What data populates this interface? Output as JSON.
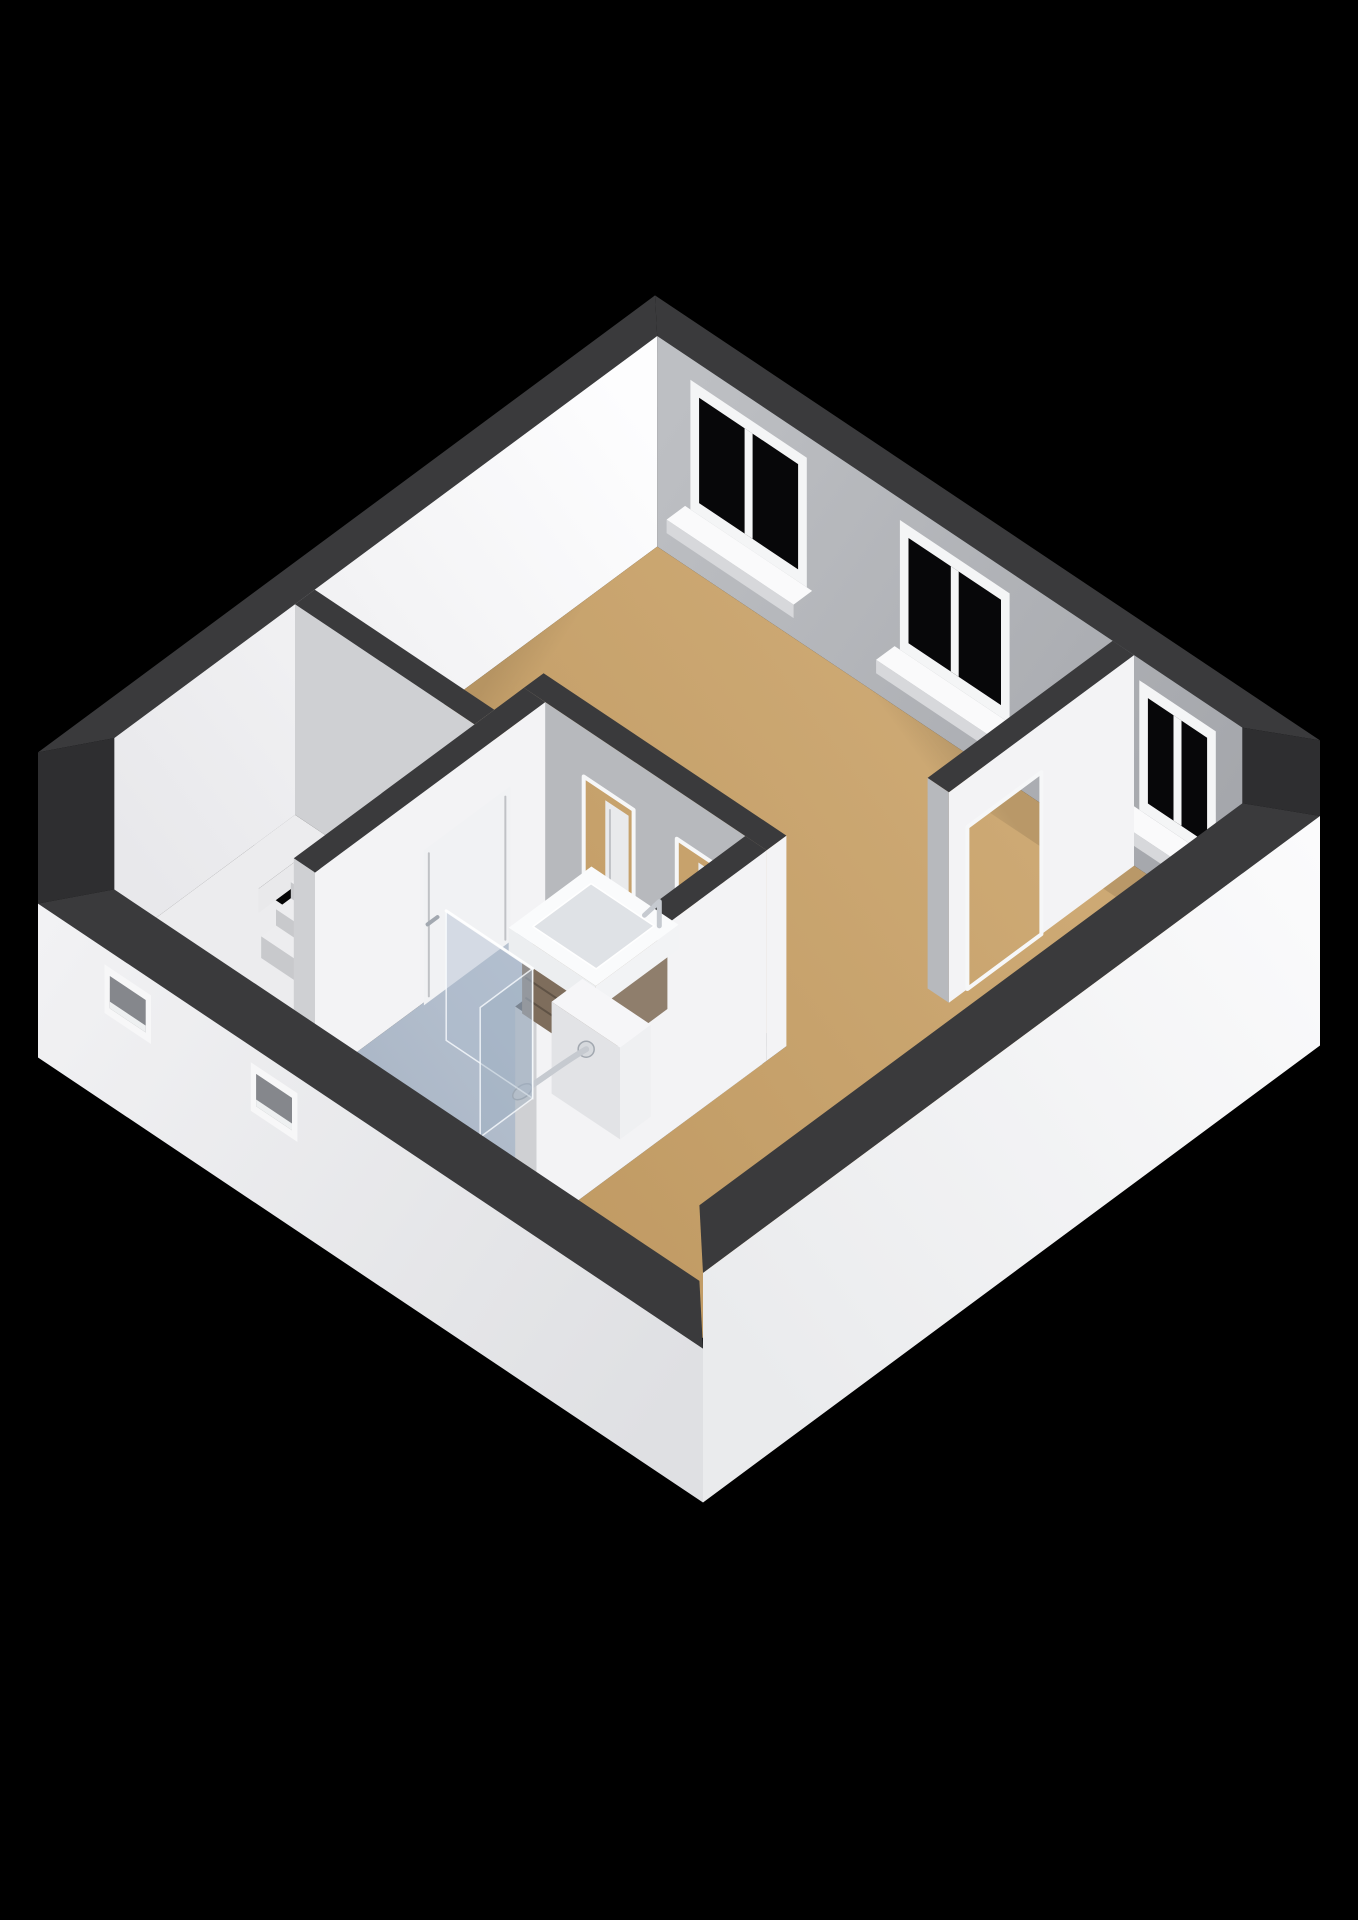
{
  "meta": {
    "title": "3D cutaway floor plan render",
    "style": "isometric dollhouse view on black background"
  },
  "scene": {
    "background": "#000000",
    "projection": {
      "origin": [
        655,
        236
      ],
      "axis_u": [
        665,
        445
      ],
      "axis_v": [
        -617,
        457
      ],
      "wall_drop": 270
    },
    "cut_heights": {
      "back_walls": 0.78,
      "southwest_wall": 0.22,
      "southeast_wall": 0.5,
      "outer_base": -0.35
    },
    "exterior": {
      "back_thickness": 0.045,
      "front_thickness": 0.075,
      "vents": {
        "z": [
          -0.02,
          0.16
        ],
        "items": [
          {
            "u": [
              0.1,
              0.17
            ]
          },
          {
            "u": [
              0.32,
              0.39
            ]
          }
        ]
      }
    },
    "colors": {
      "wall_top": "#3a3a3c",
      "wall_top_step": "#2e2e30",
      "wall_bright": "#f3f3f5",
      "wall_shade": "#b7b9bd",
      "wall_inner_light": "#cfd0d3",
      "window_frame": "#f4f5f6",
      "window_glass": "#070709",
      "sill_top": "#fafafb",
      "sill_front": "#d7d8db",
      "door_frame": "#f6f7f8",
      "door_leaf": "#e9eaec",
      "door_leaf_bright": "#f1f2f4",
      "door_groove": "#c0c2c6",
      "floor_hall": "#ececee",
      "pit_black": "#050506",
      "pit_face_bright": "#e9e9eb",
      "pit_face_shade": "#cfd0d3",
      "step_top": "#ededef",
      "step_riser": "#c8c9cc",
      "wood_top": "#9b8a77",
      "wood_front": "#7e6d5c",
      "wood_side": "#8f7e6c",
      "wood_line": "#5f5245",
      "sink_top": "#fafbfc",
      "sink_front": "#eceef0",
      "sink_side": "#f2f3f5",
      "basin": "#dfe2e6",
      "chrome": "#c6cad0",
      "chrome_deep": "#a2a8b0",
      "pony_top": "#f6f6f8",
      "pony_front": "#e2e3e6",
      "pony_side": "#eff0f2",
      "glass_fill": "rgba(172,187,204,0.42)",
      "glass_return_fill": "rgba(152,170,190,0.38)",
      "glass_edge": "rgba(250,252,255,0.8)",
      "vent_frame": "#f7f7f8",
      "vent_recess": "#85878c",
      "vent_sill": "#eef0f1"
    },
    "gradients": {
      "ne_inner": [
        "#bdbfc3",
        "#a4a6ab"
      ],
      "nw_inner": [
        "#fdfdfe",
        "#e8e8eb"
      ],
      "living": [
        "#cda974",
        "#bf9962"
      ],
      "bath": [
        "#bdc7d4",
        "#abb7c7"
      ],
      "sw_outer": [
        "#f2f2f4",
        "#dfe0e3"
      ],
      "se_outer": [
        "#fbfbfc",
        "#eaebed"
      ]
    },
    "rooms": {
      "living_room": {
        "outline": [
          [
            0.045,
            0.045
          ],
          [
            0.925,
            0.045
          ],
          [
            0.925,
            0.925
          ],
          [
            0.68,
            0.925
          ],
          [
            0.68,
            0.52
          ],
          [
            0.315,
            0.52
          ],
          [
            0.315,
            0.6
          ],
          [
            0.045,
            0.6
          ]
        ]
      },
      "hall": {
        "outline": [
          [
            0.045,
            0.632
          ],
          [
            0.315,
            0.632
          ],
          [
            0.315,
            0.925
          ],
          [
            0.045,
            0.925
          ]
        ]
      },
      "bathroom": {
        "outline": [
          [
            0.347,
            0.552
          ],
          [
            0.648,
            0.552
          ],
          [
            0.648,
            0.925
          ],
          [
            0.347,
            0.925
          ]
        ]
      }
    },
    "windows": {
      "z": [
        0.22,
        0.7
      ],
      "items": [
        {
          "name": "window-1",
          "u": [
            0.095,
            0.27
          ]
        },
        {
          "name": "window-2",
          "u": [
            0.41,
            0.575
          ]
        },
        {
          "name": "window-3",
          "u": [
            0.77,
            0.885
          ]
        }
      ]
    },
    "walls": {
      "nook_partition": {
        "u": [
          0.73,
          0.762
        ],
        "v": [
          0.045,
          0.345
        ],
        "opening_v": [
          0.195,
          0.315
        ],
        "opening_z": 0.6
      },
      "bathroom_ne": {
        "u": [
          0.315,
          0.68
        ],
        "v": [
          0.52,
          0.552
        ],
        "openings_u": [
          [
            0.405,
            0.48
          ],
          [
            0.545,
            0.62
          ]
        ],
        "opening_z": 0.6,
        "leaves_u": [
          [
            0.443,
            0.478
          ],
          [
            0.583,
            0.618
          ]
        ]
      },
      "hall_ne": {
        "u": [
          0.045,
          0.315
        ],
        "v": [
          0.6,
          0.632
        ]
      },
      "hall_bath": {
        "u": [
          0.315,
          0.347
        ],
        "v": [
          0.552,
          0.925
        ],
        "door_v": [
          0.615,
          0.755
        ],
        "door_z": 0.585
      },
      "bathroom_se": {
        "u": [
          0.648,
          0.68
        ],
        "v": [
          0.552,
          0.925
        ]
      }
    },
    "stairs": {
      "hole": {
        "u": [
          0.095,
          0.215
        ],
        "v": [
          0.645,
          0.745
        ]
      },
      "steps": [
        {
          "v": [
            0.672,
            0.697
          ],
          "z": -0.05
        },
        {
          "v": [
            0.697,
            0.721
          ],
          "z": -0.11
        },
        {
          "v": [
            0.721,
            0.745
          ],
          "z": -0.17
        }
      ]
    },
    "fixtures": {
      "vanity_cabinet": {
        "u": [
          0.445,
          0.555
        ],
        "v": [
          0.578,
          0.695
        ],
        "z": [
          0.03,
          0.26
        ]
      },
      "vanity_sink": {
        "u": [
          0.435,
          0.566
        ],
        "v": [
          0.572,
          0.706
        ],
        "z": [
          0.26,
          0.35
        ]
      },
      "pony_wall": {
        "u": [
          0.545,
          0.648
        ],
        "v": [
          0.705,
          0.755
        ],
        "z": [
          0.0,
          0.34
        ]
      },
      "shower_arm": {
        "mount": [
          0.597,
          0.755,
          0.25
        ],
        "head": [
          0.566,
          0.825,
          0.16
        ]
      },
      "glass_panel": {
        "u": [
          0.405,
          0.535
        ],
        "v": 0.775,
        "z": 0.48
      },
      "glass_return": {
        "u": 0.535,
        "v": [
          0.775,
          0.86
        ],
        "z": 0.48
      }
    }
  }
}
